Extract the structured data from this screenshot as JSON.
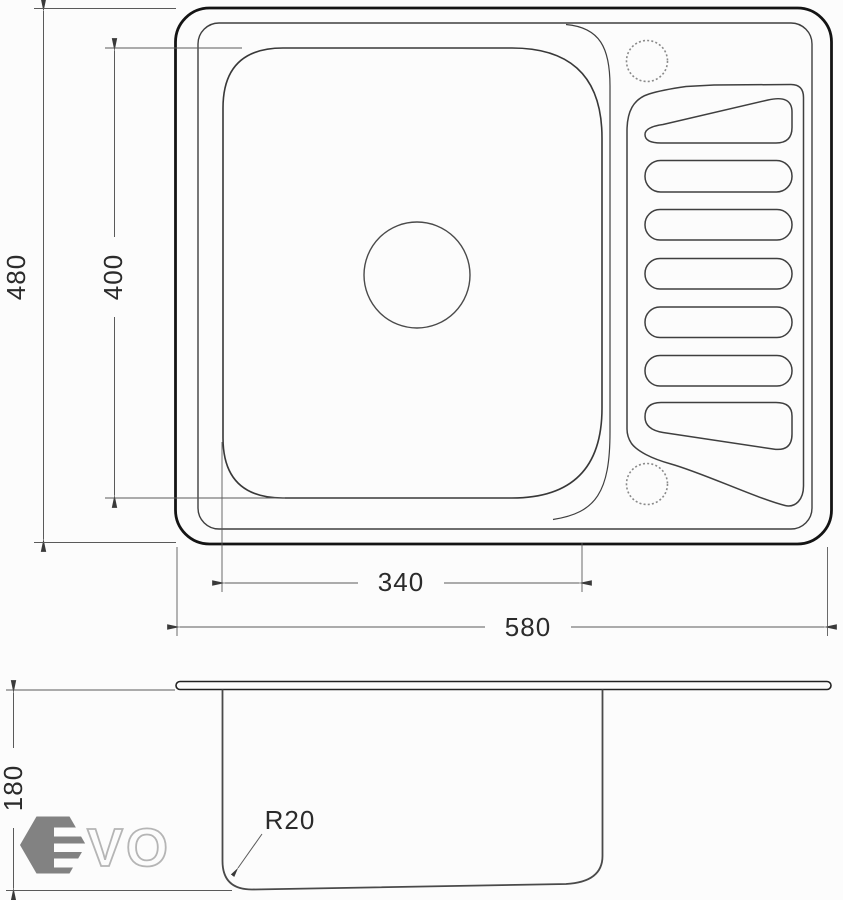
{
  "drawing": {
    "dim_depth_total": "480",
    "dim_bowl_depth": "400",
    "dim_bowl_width": "340",
    "dim_width_total": "580",
    "dim_bowl_height": "180",
    "radius_callout": "R20"
  },
  "logo": {
    "brand": "EVO",
    "outline_letters": "VO"
  },
  "colors": {
    "outer_line": "#141414",
    "inner_line": "#3f3f3f",
    "dim_line": "#5a5a5a",
    "text": "#2b2b2b",
    "hole_dotted": "#8a8a8a",
    "logo_hexagon": "#828282",
    "logo_letter_outline": "#b5b5b5",
    "background": "#fcfcfc"
  }
}
